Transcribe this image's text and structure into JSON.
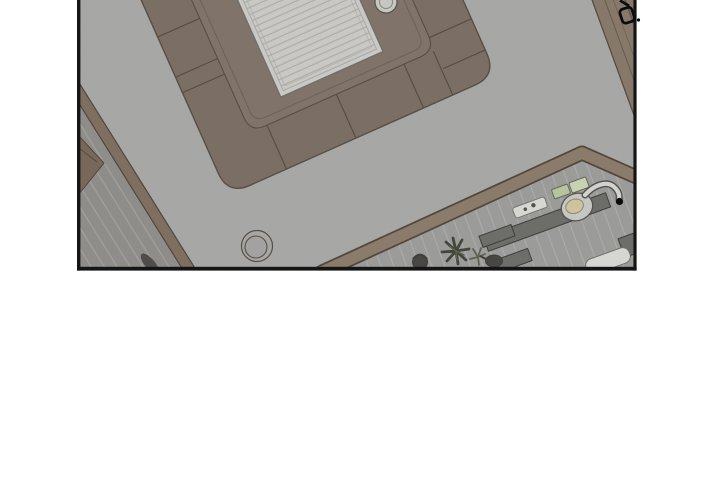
{
  "page": {
    "background": "#ffffff"
  },
  "panel": {
    "kind": "webtoon-panel",
    "description": "Overhead plan view of an apartment living room: U-shaped sectional sofa around a slatted coffee table, round rug, staircase at lower left, kitchen counter with sink at lower right. No text in panel.",
    "border_color": "#151515"
  },
  "palette": {
    "white": "#ffffff",
    "ink": "#151515",
    "glyph": "#0b0b0b",
    "floor": "#a7a7a5",
    "floorHatch": "#8f8f8d",
    "sofaBand": "#7b6e64",
    "sofaRug": "#80736a",
    "sofaLine": "#574f47",
    "tableTop": "#c9c8c4",
    "tableLine": "#aaa9a4",
    "tableEdge": "#6f6f6b",
    "wallBrown": "#7e6f60",
    "wallEdge": "#51483d",
    "rightWall": "#87796a",
    "kitchenWall": "#8b7b6b",
    "stairFloor": "#8f8d89",
    "stairLine": "#a4a19c",
    "kitchenFloor": "#9b9b99",
    "tileLine": "#aeaeab",
    "counter": "#6d6d6a",
    "counterEdge": "#3e3e3b",
    "basin": "#c6c6c2",
    "bowlYellow": "#cdc39c",
    "bowlEdge": "#8d8672",
    "faucet": "#d2d2cf",
    "metalDark": "#55534f",
    "trayWhite": "#d6d6d2",
    "greenA": "#b6c39e",
    "greenB": "#c8d2b2",
    "greenEdge": "#60614f",
    "plantDark": "#42463b",
    "plantLight": "#5c6150",
    "objDark": "#494744",
    "shadow": "#3e3c39",
    "circleFill": "#a2a2a0",
    "bowlFill": "#c6c6c3",
    "furniture": "#776859"
  },
  "scene": {
    "elements": [
      "living-room-floor",
      "sectional-sofa",
      "sofa-rug",
      "coffee-table",
      "bowl-on-sofa",
      "round-rug",
      "staircase-floor",
      "stair-wall",
      "corner-furniture",
      "floor-shadow",
      "kitchen-wall",
      "kitchen-floor",
      "kitchen-counter-long",
      "kitchen-counter-small",
      "kitchen-counter-low",
      "right-border-counter",
      "serving-tray",
      "cutting-board-a",
      "cutting-board-b",
      "sink",
      "faucet",
      "drain-dot",
      "potted-plant",
      "plant-sprig",
      "kettle",
      "pot",
      "white-appliance",
      "right-wall-cabinet",
      "panel-overlap-object"
    ]
  }
}
